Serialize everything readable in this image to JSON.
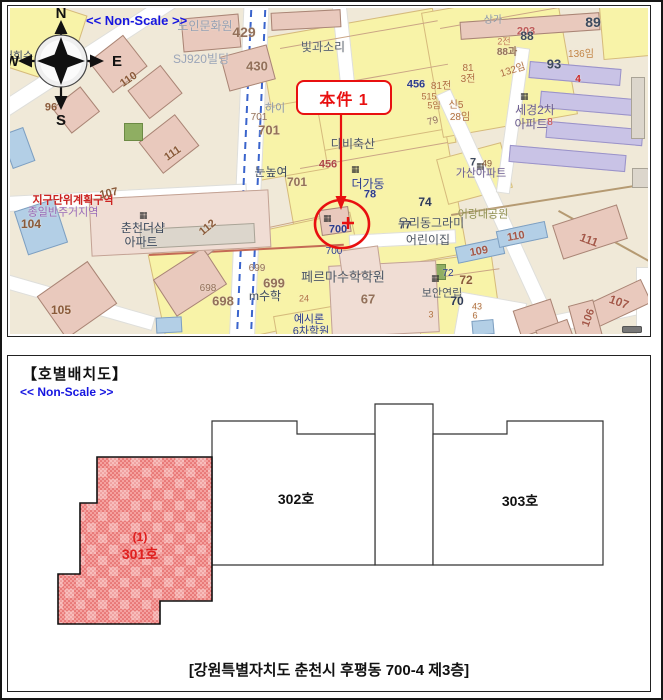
{
  "map_panel": {
    "non_scale_label": "<< Non-Scale >>",
    "compass": {
      "n": "N",
      "s": "S",
      "e": "E",
      "w": "W"
    },
    "callout": {
      "label": "本件 1"
    },
    "colors": {
      "accent_red": "#e81010",
      "road_blue": "#3a64cc",
      "parcel_yellow": "#f8f3a8",
      "map_beige": "#f0e9d8"
    },
    "roads": [
      {
        "x": 226,
        "y": -12,
        "w": 24,
        "h": 360,
        "r": 2.5
      },
      {
        "x": -25,
        "y": 35,
        "w": 215,
        "h": 15,
        "r": -33
      },
      {
        "x": -15,
        "y": 182,
        "w": 250,
        "h": 14,
        "r": -3
      },
      {
        "x": -15,
        "y": 286,
        "w": 160,
        "h": 13,
        "r": 16
      },
      {
        "x": 485,
        "y": 71,
        "w": 14,
        "h": 285,
        "r": -24.6
      },
      {
        "x": 339,
        "y": 224,
        "w": 105,
        "h": 12,
        "r": -3
      },
      {
        "x": 327,
        "y": -8,
        "w": 13,
        "h": 108,
        "r": -6
      },
      {
        "x": 536,
        "y": 294,
        "w": 135,
        "h": 16,
        "r": -12
      },
      {
        "x": 626,
        "y": 259,
        "w": 16,
        "h": 75,
        "r": 0
      },
      {
        "x": 446,
        "y": 289,
        "w": 65,
        "h": 52,
        "r": 10
      },
      {
        "x": 496,
        "y": 39,
        "w": 12,
        "h": 145,
        "r": 8
      }
    ],
    "bluedash": [
      {
        "x": 233,
        "y": -10,
        "h": 355,
        "r": 2.5
      },
      {
        "x": 247,
        "y": -10,
        "h": 355,
        "r": 2.5
      }
    ],
    "parcels": [
      {
        "x": 259,
        "y": 14,
        "w": 175,
        "h": 135,
        "r": -10
      },
      {
        "x": 281,
        "y": 134,
        "w": 165,
        "h": 125,
        "r": -10
      },
      {
        "x": 146,
        "y": 224,
        "w": 205,
        "h": 100,
        "r": -12
      },
      {
        "x": 421,
        "y": -8,
        "w": 135,
        "h": 125,
        "r": -10
      },
      {
        "x": -9,
        "y": -6,
        "w": 75,
        "h": 72,
        "r": 18
      },
      {
        "x": 406,
        "y": 249,
        "w": 80,
        "h": 88,
        "r": -8
      },
      {
        "x": 591,
        "y": -8,
        "w": 70,
        "h": 55,
        "r": -5
      },
      {
        "x": 431,
        "y": 142,
        "w": 65,
        "h": 45,
        "r": -15
      },
      {
        "x": 236,
        "y": 96,
        "w": 75,
        "h": 70,
        "r": -10
      },
      {
        "x": 266,
        "y": 300,
        "w": 90,
        "h": 40,
        "r": -10
      }
    ],
    "lines": [
      {
        "x": 139,
        "y": 246,
        "w": 195,
        "r": -3,
        "c": "#c46a55",
        "th": 2
      },
      {
        "x": 441,
        "y": 206,
        "w": 215,
        "r": -9,
        "c": "#b59a72",
        "th": 2
      },
      {
        "x": 549,
        "y": 202,
        "w": 118,
        "r": 29,
        "c": "#b59a72",
        "th": 2
      },
      {
        "x": 270,
        "y": 40,
        "w": 160,
        "r": -10,
        "c": "#caa585",
        "th": 1
      },
      {
        "x": 300,
        "y": 80,
        "w": 140,
        "r": -10,
        "c": "#caa585",
        "th": 1
      },
      {
        "x": 290,
        "y": 160,
        "w": 150,
        "r": -10,
        "c": "#caa585",
        "th": 1
      },
      {
        "x": 160,
        "y": 240,
        "w": 180,
        "r": -12,
        "c": "#caa585",
        "th": 1
      },
      {
        "x": 430,
        "y": 20,
        "w": 120,
        "r": -10,
        "c": "#caa585",
        "th": 1
      },
      {
        "x": 420,
        "y": 270,
        "w": 70,
        "r": -8,
        "c": "#caa585",
        "th": 1
      }
    ],
    "buildings": [
      {
        "x": 86,
        "y": 36,
        "w": 44,
        "h": 40,
        "r": -38,
        "t": "pink"
      },
      {
        "x": 124,
        "y": 66,
        "w": 42,
        "h": 36,
        "r": -38,
        "t": "pink"
      },
      {
        "x": 48,
        "y": 86,
        "w": 36,
        "h": 32,
        "r": -38,
        "t": "pink"
      },
      {
        "x": 136,
        "y": 116,
        "w": 46,
        "h": 40,
        "r": -38,
        "t": "pink"
      },
      {
        "x": 36,
        "y": 266,
        "w": 62,
        "h": 52,
        "r": -35,
        "t": "pink"
      },
      {
        "x": 150,
        "y": 252,
        "w": 60,
        "h": 44,
        "r": -33,
        "t": "pink"
      },
      {
        "x": 183,
        "y": 205,
        "w": 40,
        "h": 34,
        "r": -38,
        "t": "pink"
      },
      {
        "x": 172,
        "y": 8,
        "w": 58,
        "h": 34,
        "r": -5,
        "t": "pink"
      },
      {
        "x": 214,
        "y": 42,
        "w": 48,
        "h": 36,
        "r": -15,
        "t": "pink"
      },
      {
        "x": 261,
        "y": 3,
        "w": 70,
        "h": 18,
        "r": -3,
        "t": "pink"
      },
      {
        "x": 450,
        "y": 9,
        "w": 140,
        "h": 18,
        "r": -4,
        "t": "pink"
      },
      {
        "x": 114,
        "y": 115,
        "w": 19,
        "h": 18,
        "r": 0,
        "t": "green"
      },
      {
        "x": 416,
        "y": 256,
        "w": 20,
        "h": 16,
        "r": 0,
        "t": "green"
      },
      {
        "x": -4,
        "y": 122,
        "w": 24,
        "h": 36,
        "r": -20,
        "t": "blue"
      },
      {
        "x": 10,
        "y": 196,
        "w": 42,
        "h": 46,
        "r": -18,
        "t": "blue"
      },
      {
        "x": 446,
        "y": 234,
        "w": 48,
        "h": 17,
        "r": -12,
        "t": "blue"
      },
      {
        "x": 487,
        "y": 218,
        "w": 50,
        "h": 17,
        "r": -12,
        "t": "blue"
      },
      {
        "x": 462,
        "y": 312,
        "w": 22,
        "h": 15,
        "r": -5,
        "t": "blue"
      },
      {
        "x": 146,
        "y": 309,
        "w": 26,
        "h": 16,
        "r": -3,
        "t": "blue"
      },
      {
        "x": 80,
        "y": 186,
        "w": 180,
        "h": 58,
        "r": -3,
        "t": "pink2"
      },
      {
        "x": 130,
        "y": 218,
        "w": 115,
        "h": 20,
        "r": -3,
        "t": "gray"
      },
      {
        "x": 320,
        "y": 255,
        "w": 108,
        "h": 72,
        "r": -3,
        "t": "pink2"
      },
      {
        "x": 519,
        "y": 57,
        "w": 92,
        "h": 17,
        "r": 5,
        "t": "purple"
      },
      {
        "x": 530,
        "y": 87,
        "w": 97,
        "h": 17,
        "r": 5,
        "t": "purple"
      },
      {
        "x": 536,
        "y": 117,
        "w": 97,
        "h": 17,
        "r": 5,
        "t": "purple"
      },
      {
        "x": 499,
        "y": 142,
        "w": 117,
        "h": 17,
        "r": 5,
        "t": "purple"
      },
      {
        "x": 621,
        "y": 69,
        "w": 14,
        "h": 62,
        "r": 0,
        "t": "gray"
      },
      {
        "x": 640,
        "y": 72,
        "w": 13,
        "h": 60,
        "r": 0,
        "t": "gray"
      },
      {
        "x": 546,
        "y": 206,
        "w": 68,
        "h": 36,
        "r": -18,
        "t": "pink"
      },
      {
        "x": 581,
        "y": 282,
        "w": 58,
        "h": 26,
        "r": -25,
        "t": "pink"
      },
      {
        "x": 563,
        "y": 294,
        "w": 26,
        "h": 42,
        "r": -15,
        "t": "pink"
      },
      {
        "x": 506,
        "y": 296,
        "w": 40,
        "h": 28,
        "r": -18,
        "t": "pink"
      },
      {
        "x": 528,
        "y": 316,
        "w": 34,
        "h": 22,
        "r": -20,
        "t": "pink"
      },
      {
        "x": 310,
        "y": 200,
        "w": 30,
        "h": 26,
        "r": -8,
        "t": "pink"
      },
      {
        "x": 330,
        "y": 240,
        "w": 40,
        "h": 26,
        "r": -8,
        "t": "pink2"
      },
      {
        "x": 622,
        "y": 160,
        "w": 28,
        "h": 20,
        "r": 0,
        "t": "gray"
      }
    ],
    "icons": [
      {
        "x": 129,
        "y": 203
      },
      {
        "x": 313,
        "y": 206
      },
      {
        "x": 341,
        "y": 157
      },
      {
        "x": 510,
        "y": 84
      },
      {
        "x": 421,
        "y": 266
      },
      {
        "x": 466,
        "y": 154
      }
    ],
    "labels": [
      {
        "t": "노인문화원",
        "x": 195,
        "y": 18,
        "s": 12,
        "c": "#96a1b4"
      },
      {
        "t": "SJ920빌딩",
        "x": 191,
        "y": 51,
        "s": 12,
        "c": "#9aa5b8"
      },
      {
        "t": "429",
        "x": 234,
        "y": 24,
        "s": 14,
        "c": "#93705a",
        "b": 1
      },
      {
        "t": "430",
        "x": 247,
        "y": 58,
        "s": 13,
        "c": "#93705a",
        "b": 1
      },
      {
        "t": "빛과소리",
        "x": 313,
        "y": 39,
        "s": 12,
        "c": "#5a6472"
      },
      {
        "t": "203",
        "x": 516,
        "y": 24,
        "s": 11,
        "c": "#c05a5a",
        "b": 1
      },
      {
        "t": "상가",
        "x": 483,
        "y": 13,
        "s": 10,
        "c": "#8a97a8"
      },
      {
        "t": "88",
        "x": 517,
        "y": 28,
        "s": 12,
        "c": "#3d4a5e",
        "b": 1
      },
      {
        "t": "2전",
        "x": 494,
        "y": 34,
        "s": 9,
        "c": "#c07555"
      },
      {
        "t": "88과",
        "x": 497,
        "y": 45,
        "s": 10,
        "c": "#93705a",
        "b": 1
      },
      {
        "t": "89",
        "x": 583,
        "y": 14,
        "s": 14,
        "c": "#3d4a5e",
        "b": 1
      },
      {
        "t": "136임",
        "x": 571,
        "y": 47,
        "s": 10,
        "c": "#c28445"
      },
      {
        "t": "93",
        "x": 544,
        "y": 56,
        "s": 13,
        "c": "#3d4a5e",
        "b": 1
      },
      {
        "t": "4",
        "x": 568,
        "y": 72,
        "s": 10,
        "c": "#cc2a2a",
        "b": 1
      },
      {
        "t": "132임",
        "x": 503,
        "y": 63,
        "s": 10,
        "c": "#b06f3f",
        "r": -18
      },
      {
        "t": "81",
        "x": 458,
        "y": 61,
        "s": 10,
        "c": "#b06f3f"
      },
      {
        "t": "3전",
        "x": 458,
        "y": 72,
        "s": 10,
        "c": "#b06f3f"
      },
      {
        "t": "456",
        "x": 406,
        "y": 77,
        "s": 11,
        "c": "#2d3d8e",
        "b": 1
      },
      {
        "t": "81전",
        "x": 431,
        "y": 79,
        "s": 10,
        "c": "#b06f3f"
      },
      {
        "t": "515",
        "x": 419,
        "y": 89,
        "s": 9,
        "c": "#b06f3f"
      },
      {
        "t": "5임",
        "x": 424,
        "y": 98,
        "s": 9,
        "c": "#b06f3f"
      },
      {
        "t": "신5",
        "x": 446,
        "y": 98,
        "s": 10,
        "c": "#b06f3f"
      },
      {
        "t": "28임",
        "x": 450,
        "y": 110,
        "s": 10,
        "c": "#b06f3f"
      },
      {
        "t": "세경2차",
        "x": 525,
        "y": 102,
        "s": 12,
        "c": "#6a5d92"
      },
      {
        "t": "아파트",
        "x": 521,
        "y": 116,
        "s": 12,
        "c": "#6a5d92"
      },
      {
        "t": "8",
        "x": 540,
        "y": 115,
        "s": 10,
        "c": "#cc4a4a"
      },
      {
        "t": "79",
        "x": 423,
        "y": 114,
        "s": 10,
        "c": "#93705a",
        "r": -15
      },
      {
        "t": "가산아파트",
        "x": 471,
        "y": 166,
        "s": 11,
        "c": "#6a5d92"
      },
      {
        "t": "7",
        "x": 463,
        "y": 155,
        "s": 11,
        "c": "#3d4a5e",
        "b": 1
      },
      {
        "t": "49",
        "x": 477,
        "y": 156,
        "s": 9,
        "c": "#8a5a3a"
      },
      {
        "t": "어랑대공원",
        "x": 473,
        "y": 207,
        "s": 11,
        "c": "#8f8f4f"
      },
      {
        "t": "109",
        "x": 469,
        "y": 244,
        "s": 11,
        "c": "#a5584a",
        "b": 1,
        "r": -10
      },
      {
        "t": "110",
        "x": 506,
        "y": 229,
        "s": 11,
        "c": "#a5584a",
        "b": 1,
        "r": -10
      },
      {
        "t": "111",
        "x": 579,
        "y": 232,
        "s": 12,
        "c": "#a5584a",
        "b": 1,
        "r": 20
      },
      {
        "t": "107",
        "x": 609,
        "y": 294,
        "s": 12,
        "c": "#a5584a",
        "b": 1,
        "r": 20
      },
      {
        "t": "106",
        "x": 579,
        "y": 310,
        "s": 11,
        "c": "#a5584a",
        "b": 1,
        "r": -70
      },
      {
        "t": "초",
        "x": 642,
        "y": 160,
        "s": 10,
        "c": "#333333"
      },
      {
        "t": "다비축산",
        "x": 343,
        "y": 136,
        "s": 12,
        "c": "#4d5766"
      },
      {
        "t": "456",
        "x": 318,
        "y": 157,
        "s": 11,
        "c": "#b04848",
        "b": 1
      },
      {
        "t": "더가동",
        "x": 358,
        "y": 176,
        "s": 12,
        "c": "#2d3d8e"
      },
      {
        "t": "78",
        "x": 360,
        "y": 187,
        "s": 11,
        "c": "#2d3d8e",
        "b": 1
      },
      {
        "t": "74",
        "x": 415,
        "y": 194,
        "s": 12,
        "c": "#2d3a56",
        "b": 1
      },
      {
        "t": "77",
        "x": 395,
        "y": 218,
        "s": 11,
        "c": "#2d3a56",
        "b": 1
      },
      {
        "t": "우리동그라미",
        "x": 421,
        "y": 215,
        "s": 12,
        "c": "#4d5766"
      },
      {
        "t": "어린이집",
        "x": 418,
        "y": 232,
        "s": 12,
        "c": "#4d5766"
      },
      {
        "t": "눈높여",
        "x": 261,
        "y": 164,
        "s": 12,
        "c": "#3d4a5e"
      },
      {
        "t": "701",
        "x": 287,
        "y": 174,
        "s": 12,
        "c": "#93705a",
        "b": 1
      },
      {
        "t": "하이",
        "x": 265,
        "y": 101,
        "s": 11,
        "c": "#8a97a8"
      },
      {
        "t": "701",
        "x": 249,
        "y": 110,
        "s": 10,
        "c": "#93705a"
      },
      {
        "t": "701",
        "x": 259,
        "y": 122,
        "s": 13,
        "c": "#93705a",
        "b": 1
      },
      {
        "t": "700",
        "x": 328,
        "y": 222,
        "s": 11,
        "c": "#2d3d8e",
        "b": 1
      },
      {
        "t": "700",
        "x": 324,
        "y": 244,
        "s": 10,
        "c": "#2d3d8e"
      },
      {
        "t": "699",
        "x": 247,
        "y": 261,
        "s": 10,
        "c": "#93705a"
      },
      {
        "t": "699",
        "x": 264,
        "y": 275,
        "s": 13,
        "c": "#93705a",
        "b": 1
      },
      {
        "t": "698",
        "x": 198,
        "y": 281,
        "s": 10,
        "c": "#93705a"
      },
      {
        "t": "698",
        "x": 213,
        "y": 293,
        "s": 13,
        "c": "#93705a",
        "b": 1
      },
      {
        "t": "m수학",
        "x": 255,
        "y": 288,
        "s": 12,
        "c": "#3d4a5e"
      },
      {
        "t": "페르마수학학원",
        "x": 333,
        "y": 269,
        "s": 13,
        "c": "#4d5766"
      },
      {
        "t": "24",
        "x": 294,
        "y": 291,
        "s": 9,
        "c": "#b06f3f"
      },
      {
        "t": "67",
        "x": 358,
        "y": 291,
        "s": 13,
        "c": "#93705a",
        "b": 1
      },
      {
        "t": "예시론",
        "x": 299,
        "y": 312,
        "s": 11,
        "c": "#2d3d8e"
      },
      {
        "t": "6차학원",
        "x": 301,
        "y": 324,
        "s": 11,
        "c": "#2d3d8e"
      },
      {
        "t": "72",
        "x": 438,
        "y": 266,
        "s": 10,
        "c": "#2d3d8e"
      },
      {
        "t": "72",
        "x": 456,
        "y": 272,
        "s": 12,
        "c": "#8a5a3a",
        "b": 1
      },
      {
        "t": "보안연립",
        "x": 432,
        "y": 286,
        "s": 11,
        "c": "#4d5766"
      },
      {
        "t": "70",
        "x": 447,
        "y": 293,
        "s": 12,
        "c": "#2d3a56",
        "b": 1
      },
      {
        "t": "43",
        "x": 467,
        "y": 299,
        "s": 9,
        "c": "#b06f3f"
      },
      {
        "t": "6",
        "x": 465,
        "y": 308,
        "s": 9,
        "c": "#b06f3f"
      },
      {
        "t": "3",
        "x": 421,
        "y": 307,
        "s": 9,
        "c": "#b06f3f"
      },
      {
        "t": "지구단위계획구역",
        "x": 63,
        "y": 193,
        "s": 11,
        "c": "#cc2222",
        "b": 1
      },
      {
        "t": "종일반주거지역",
        "x": 53,
        "y": 205,
        "s": 11,
        "c": "#9a6ab8"
      },
      {
        "t": "104",
        "x": 21,
        "y": 216,
        "s": 12,
        "c": "#8a5a3a",
        "b": 1
      },
      {
        "t": "107",
        "x": 99,
        "y": 186,
        "s": 11,
        "c": "#8a5a3a",
        "b": 1,
        "r": -12
      },
      {
        "t": "춘천더샵",
        "x": 133,
        "y": 220,
        "s": 12,
        "c": "#3d4a5e"
      },
      {
        "t": "아파트",
        "x": 131,
        "y": 234,
        "s": 12,
        "c": "#3d4a5e"
      },
      {
        "t": "112",
        "x": 198,
        "y": 220,
        "s": 11,
        "c": "#8a5a3a",
        "b": 1,
        "r": -40
      },
      {
        "t": "105",
        "x": 51,
        "y": 302,
        "s": 12,
        "c": "#8a5a3a",
        "b": 1
      },
      {
        "t": "96",
        "x": 41,
        "y": 100,
        "s": 11,
        "c": "#8a5a3a",
        "b": 1
      },
      {
        "t": "110",
        "x": 119,
        "y": 72,
        "s": 11,
        "c": "#8a5a3a",
        "b": 1,
        "r": -35
      },
      {
        "t": "111",
        "x": 163,
        "y": 146,
        "s": 11,
        "c": "#8a5a3a",
        "b": 1,
        "r": -35
      },
      {
        "t": "서회수",
        "x": 8,
        "y": 49,
        "s": 11,
        "c": "#3d4a5e"
      }
    ]
  },
  "plan_panel": {
    "title": "【호별배치도】",
    "non_scale_label": "<< Non-Scale >>",
    "caption": "[강원특별자치도 춘천시 후평동 700-4 제3층]",
    "units": [
      {
        "id": "shaft",
        "label": "",
        "points": "367,48 425,48 425,209 367,209",
        "highlight": false
      },
      {
        "id": "302",
        "label": "302호",
        "points": "204,65 289,65 289,78 367,78 367,209 204,209",
        "lx": 288,
        "ly": 148,
        "highlight": false
      },
      {
        "id": "303",
        "label": "303호",
        "points": "425,78 499,78 499,65 595,65 595,209 425,209",
        "lx": 512,
        "ly": 150,
        "highlight": false
      },
      {
        "id": "301",
        "label": "301호",
        "sub": "(1)",
        "points": "89,101 204,101 204,245 152,245 152,268 50,268 50,218 72,218 72,147 89,147",
        "lx": 132,
        "ly": 203,
        "sy": 185,
        "highlight": true
      }
    ],
    "highlight_text_color": "#e02020"
  }
}
